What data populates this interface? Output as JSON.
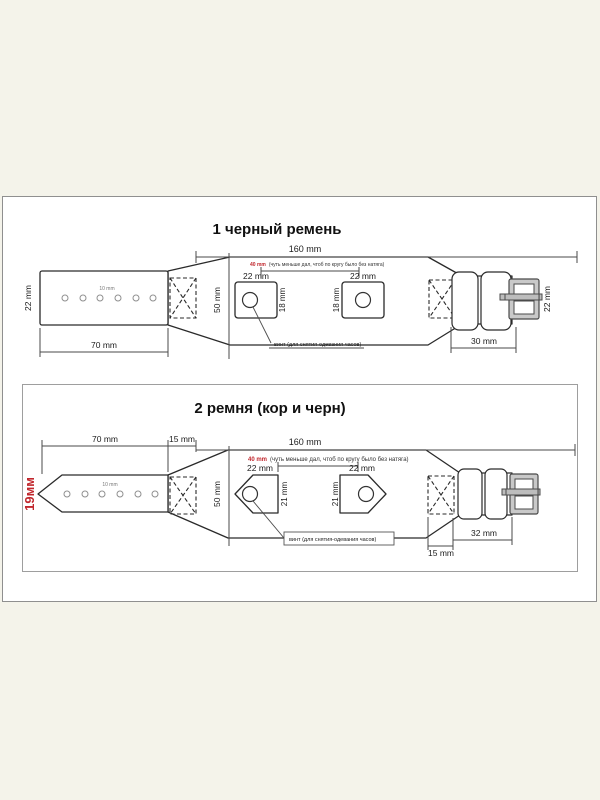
{
  "page": {
    "background": "#f4f3ea"
  },
  "colors": {
    "accent_red": "#c1272d",
    "ink": "#2a2a2a",
    "dimension": "#4a4a4a",
    "panel_border": "#8f8f8f"
  },
  "panel1": {
    "title": "1 черный ремень",
    "dims": {
      "total": "160 mm",
      "gap_value": "40 mm",
      "gap_note": "(чуть меньше дал, чтоб по кругу было без натяга)",
      "pad_left_w": "22 mm",
      "pad_right_w": "22 mm",
      "pad_left_h": "18 mm",
      "pad_right_h": "18 mm",
      "body_h": "50 mm",
      "tail_w": "22 mm",
      "tail_len": "70 mm",
      "hole_pitch": "10 mm",
      "buckle_len": "30 mm",
      "buckle_w": "22 mm"
    },
    "notes": {
      "screw": "винт (для снятия-одевания часов)"
    }
  },
  "panel2": {
    "title": "2 ремня (кор и черн)",
    "strap_width": "19мм",
    "dims": {
      "tail_len": "70 mm",
      "stitch_top": "15 mm",
      "total": "160 mm",
      "gap_value": "40 mm",
      "gap_note": "(чуть меньше дал, чтоб по кругу было без натяга)",
      "pad_left_w": "22 mm",
      "pad_right_w": "22 mm",
      "pad_left_h": "21 mm",
      "pad_right_h": "21 mm",
      "body_h": "50 mm",
      "hole_pitch": "10 mm",
      "buckle_len": "32 mm",
      "stitch_bottom": "15 mm"
    },
    "notes": {
      "screw": "винт (для снятия-одевания часов)"
    }
  }
}
